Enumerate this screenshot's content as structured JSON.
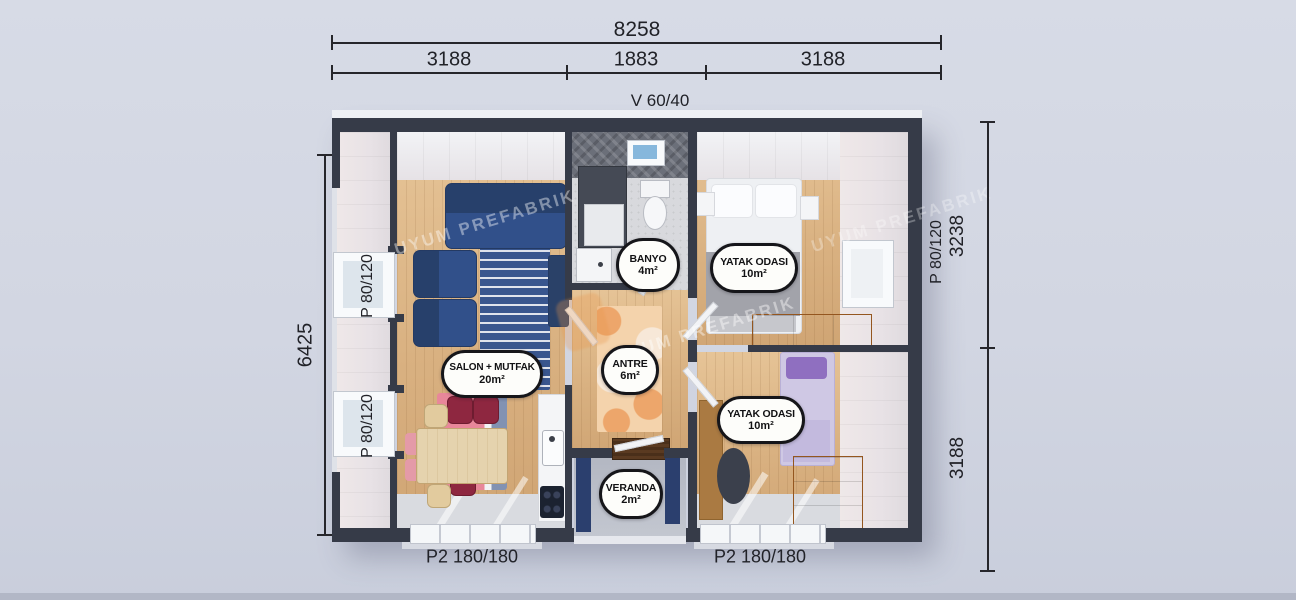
{
  "watermark": {
    "text": "UYUM PREFABRIK"
  },
  "dimensions": {
    "top_total": "8258",
    "top_segments": [
      "3188",
      "1883",
      "3188"
    ],
    "top_window": "V 60/40",
    "left_total": "6425",
    "left_windows": [
      "P 80/120",
      "P 80/120"
    ],
    "right_segments": [
      "3238",
      "3188"
    ],
    "right_window": "P 80/120",
    "bottom_doors": [
      "P2 180/180",
      "P2 180/180"
    ]
  },
  "rooms": [
    {
      "name": "BANYO",
      "area": "4m²"
    },
    {
      "name": "YATAK ODASI",
      "area": "10m²"
    },
    {
      "name": "SALON + MUTFAK",
      "area": "20m²"
    },
    {
      "name": "ANTRE",
      "area": "6m²"
    },
    {
      "name": "YATAK ODASI",
      "area": "10m²"
    },
    {
      "name": "VERANDA",
      "area": "2m²"
    }
  ],
  "colors": {
    "background": "#d2d6e2",
    "wall": "#363b48",
    "wood_floor": "#d9b181",
    "navy_furniture": "#2c4677",
    "label_border": "#16161a",
    "label_bg": "#fdfdfa",
    "veranda_wall_navy": "#2b3f6e",
    "accent_orange": "#e8964a"
  }
}
